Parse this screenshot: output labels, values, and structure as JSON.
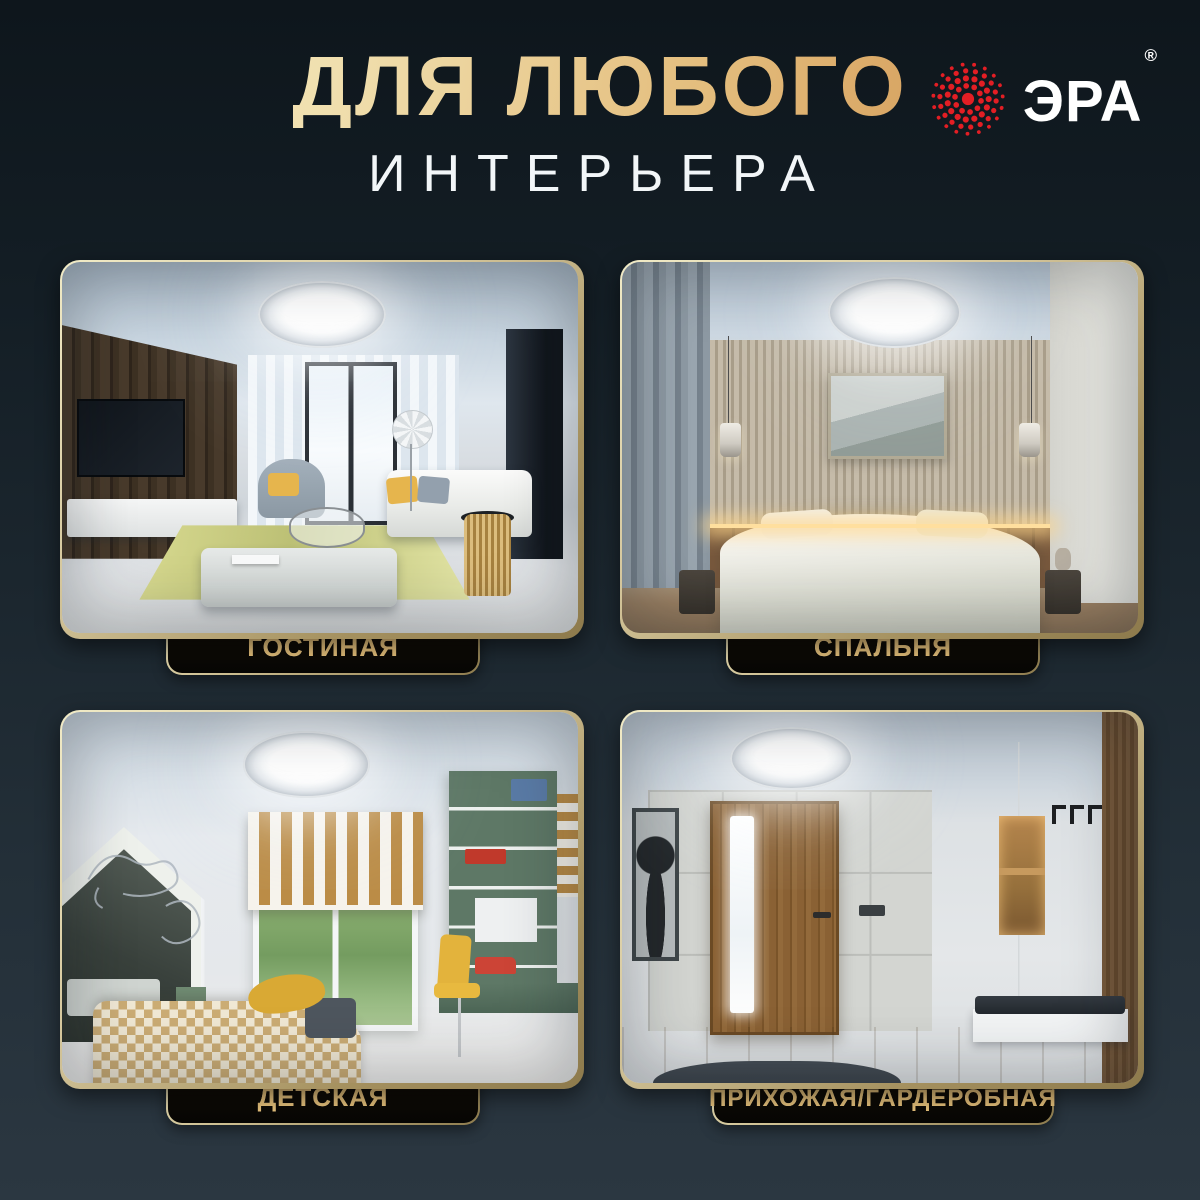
{
  "header": {
    "title_line1": "ДЛЯ ЛЮБОГО",
    "title_line2": "ИНТЕРЬЕРА"
  },
  "brand": {
    "name": "ЭРА",
    "registered_mark": "®",
    "logo_dot_color": "#e31e24",
    "text_color": "#ffffff"
  },
  "theme": {
    "background_top": "#0e161c",
    "background_bottom": "#2b3741",
    "gold_light": "#f4e7bd",
    "gold_dark": "#cf9450",
    "card_border_light": "#f1ebc7",
    "card_border_dark": "#8d7a4c",
    "plate_background": "#0e0b06",
    "subtitle_color": "#f2f6f8"
  },
  "rooms": [
    {
      "id": "living-room",
      "label": "ГОСТИНАЯ"
    },
    {
      "id": "bedroom",
      "label": "СПАЛЬНЯ"
    },
    {
      "id": "kids-room",
      "label": "ДЕТСКАЯ"
    },
    {
      "id": "hallway",
      "label": "ПРИХОЖАЯ/ГАРДЕРОБНАЯ"
    }
  ]
}
